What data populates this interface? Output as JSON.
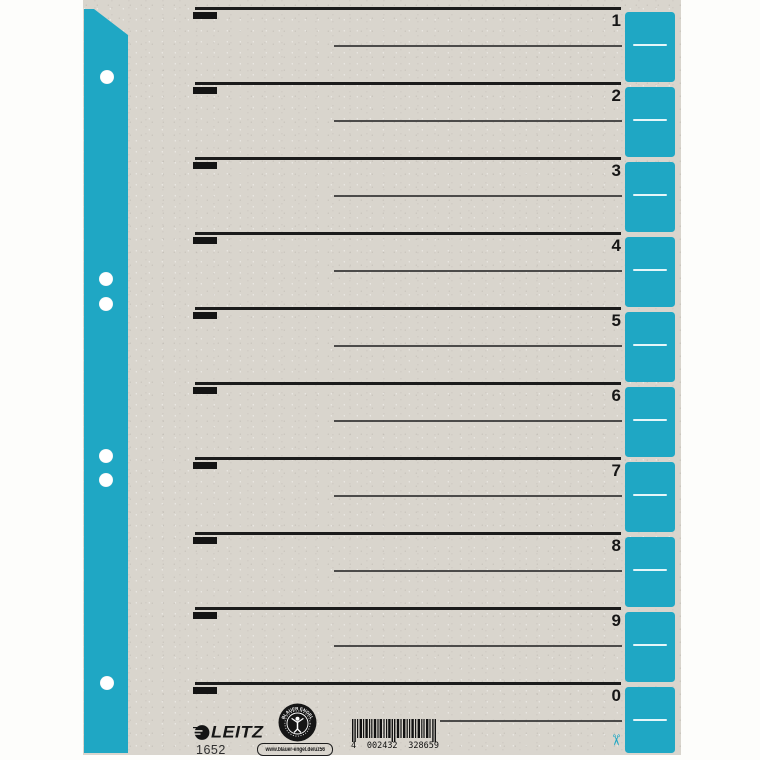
{
  "colors": {
    "teal": "#1fa7c4",
    "sheet_grey": "#d9d5cd",
    "ink_black": "#1b1b1b"
  },
  "rows": [
    "1",
    "2",
    "3",
    "4",
    "5",
    "6",
    "7",
    "8",
    "9",
    "0"
  ],
  "footer": {
    "brand": "LEITZ",
    "product_number": "1652",
    "eco_seal_text": "BLAUER ENGEL",
    "eco_url": "www.blauer-engel.de/uz56",
    "barcode": {
      "prefix": "4",
      "group1": "002432",
      "group2": "328659"
    }
  },
  "icons": {
    "scissors": "✂"
  }
}
